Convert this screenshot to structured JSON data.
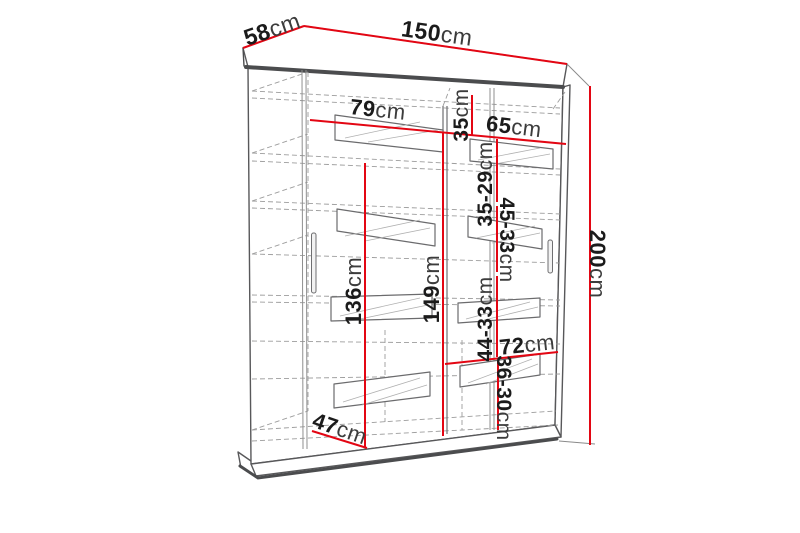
{
  "diagram": {
    "type": "furniture-dimension-diagram",
    "subject": "sliding-door-wardrobe",
    "unit": "cm",
    "colors": {
      "dimension_line": "#e30613",
      "outline": "#58585a",
      "dashed_line": "#9c9c9c",
      "label_text": "#1b1b1b",
      "background": "#ffffff"
    },
    "dims": {
      "top_depth": {
        "value": "58",
        "unit": "cm"
      },
      "top_width": {
        "value": "150",
        "unit": "cm"
      },
      "left_shelf_width": {
        "value": "79",
        "unit": "cm"
      },
      "right_shelf_width": {
        "value": "65",
        "unit": "cm"
      },
      "top_right_gap": {
        "value": "35",
        "unit": "cm"
      },
      "right_gap_1": {
        "value": "35-29",
        "unit": "cm"
      },
      "right_gap_2": {
        "value": "45-33",
        "unit": "cm"
      },
      "left_interior_height": {
        "value": "136",
        "unit": "cm"
      },
      "center_interior_height": {
        "value": "149",
        "unit": "cm"
      },
      "right_gap_3": {
        "value": "44-33",
        "unit": "cm"
      },
      "right_lower_width": {
        "value": "72",
        "unit": "cm"
      },
      "right_gap_4": {
        "value": "36-30",
        "unit": "cm"
      },
      "interior_depth": {
        "value": "47",
        "unit": "cm"
      },
      "total_height": {
        "value": "200",
        "unit": "cm"
      }
    }
  }
}
